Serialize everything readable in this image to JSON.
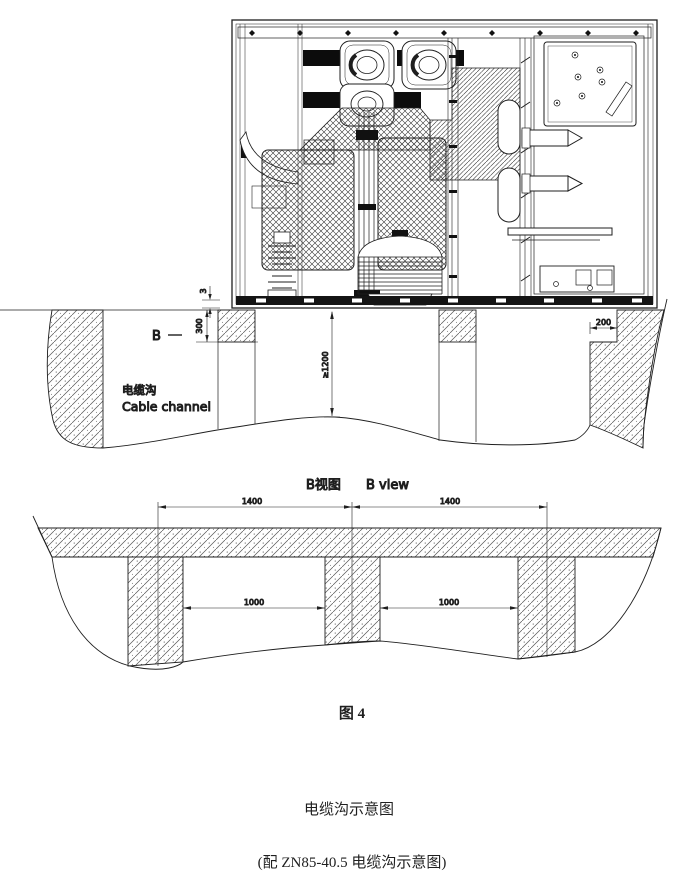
{
  "drawing": {
    "section_view": {
      "label_b": "B",
      "dim_gap": "3",
      "dim_foundation_depth": "300",
      "dim_channel_depth": "≥1200",
      "dim_notch_width": "200",
      "channel_label_zh": "电缆沟",
      "channel_label_en": "Cable channel"
    },
    "b_view": {
      "title_zh": "B视图",
      "title_en": "B view",
      "dim_span_left": "1400",
      "dim_span_right": "1400",
      "dim_opening_left": "1000",
      "dim_opening_right": "1000"
    },
    "captions": {
      "figure_label": "图 4",
      "title": "电缆沟示意图",
      "subtitle": "(配 ZN85-40.5 电缆沟示意图)"
    },
    "colors": {
      "line": "#1f1f1f",
      "background": "#ffffff"
    }
  }
}
